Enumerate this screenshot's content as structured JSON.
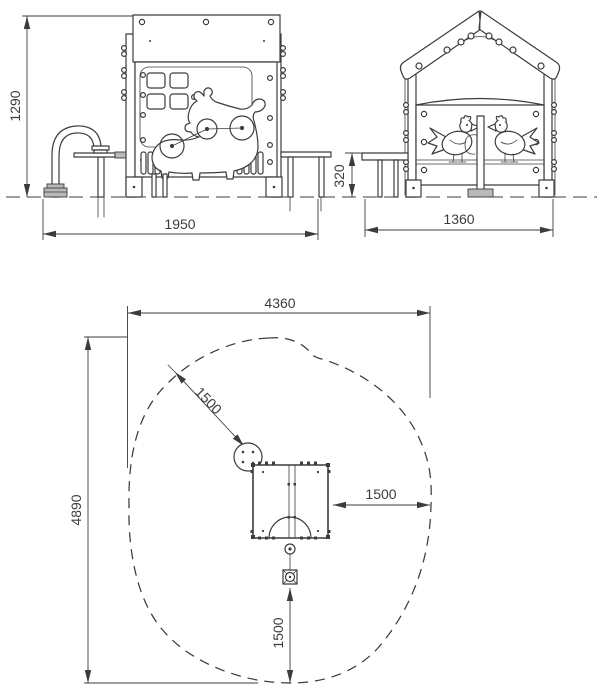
{
  "colors": {
    "line": "#3c3c3c",
    "background": "#ffffff",
    "plate_fill": "#b9b9b9"
  },
  "dimensions": {
    "front_height": "1290",
    "front_width": "1950",
    "side_seat_height": "320",
    "side_width": "1360",
    "plan_width": "4360",
    "plan_depth": "4890",
    "plan_clearance_diagonal": "1500",
    "plan_clearance_side": "1500",
    "plan_clearance_bottom": "1500"
  }
}
